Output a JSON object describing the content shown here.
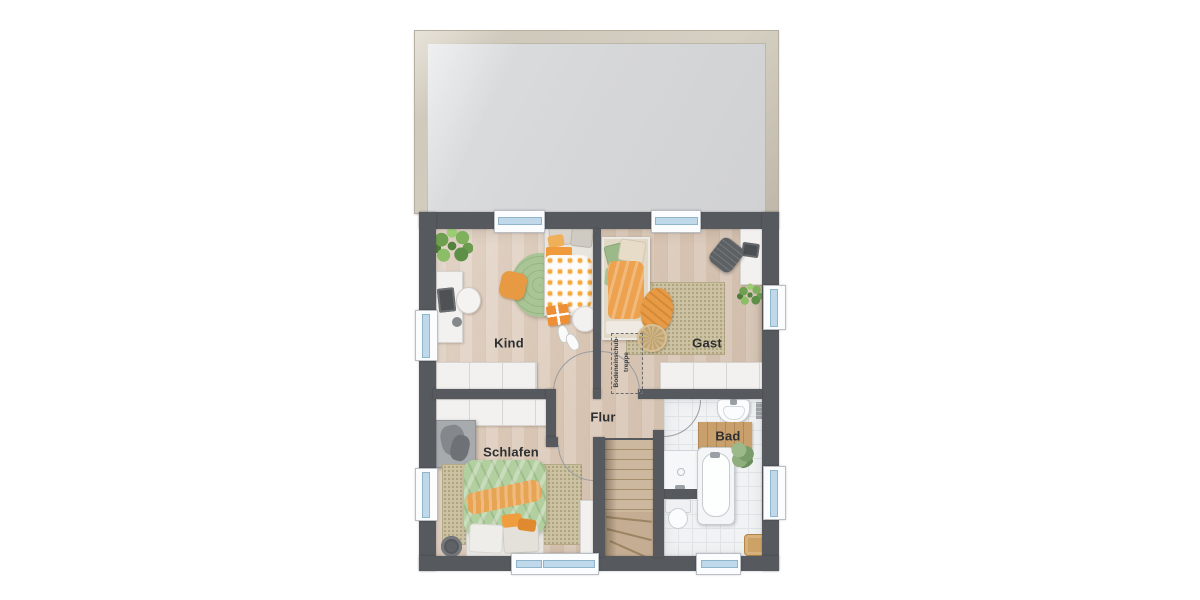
{
  "plan": {
    "type": "floor-plan-top-view",
    "labels": {
      "kind": "Kind",
      "gast": "Gast",
      "flur": "Flur",
      "schlafen": "Schlafen",
      "bad": "Bad"
    },
    "attic_ladder": {
      "line1": "Bodeneinschub-",
      "line2": "treppe"
    },
    "rooms": [
      {
        "id": "kind",
        "label": "Kind",
        "furniture": [
          "plant",
          "desk",
          "desk-chair",
          "laptop",
          "waste-bin",
          "bed",
          "round-rug",
          "floor-cushion",
          "gift-box",
          "slippers",
          "pouf",
          "built-in-wardrobe"
        ]
      },
      {
        "id": "gast",
        "label": "Gast",
        "furniture": [
          "bed",
          "rug",
          "pouf",
          "throw-blanket",
          "desk",
          "office-chair",
          "plant",
          "sideboard",
          "attic-ladder-area"
        ]
      },
      {
        "id": "flur",
        "label": "Flur",
        "furniture": [
          "staircase"
        ]
      },
      {
        "id": "schlafen",
        "label": "Schlafen",
        "furniture": [
          "built-in-wardrobe",
          "valet-clothes-stand",
          "bed",
          "rug",
          "laundry-basket",
          "tall-cabinet"
        ]
      },
      {
        "id": "bad",
        "label": "Bad",
        "furniture": [
          "wash-basin",
          "wooden-bath-mat",
          "shower",
          "toilet",
          "bathtub",
          "towel",
          "wooden-stool",
          "radiator"
        ]
      }
    ],
    "colors": {
      "wall": "#56595d",
      "wood_floor": "#ddcbbb",
      "tile_floor": "#f0f2f3",
      "roof": "#d6d7d9",
      "roof_frame": "#cfc9bc",
      "window_glass": "#bfd9ea",
      "accent_orange": "#ec9c44",
      "accent_green": "#a9c595",
      "rug_beige": "#cdc3a3"
    }
  }
}
